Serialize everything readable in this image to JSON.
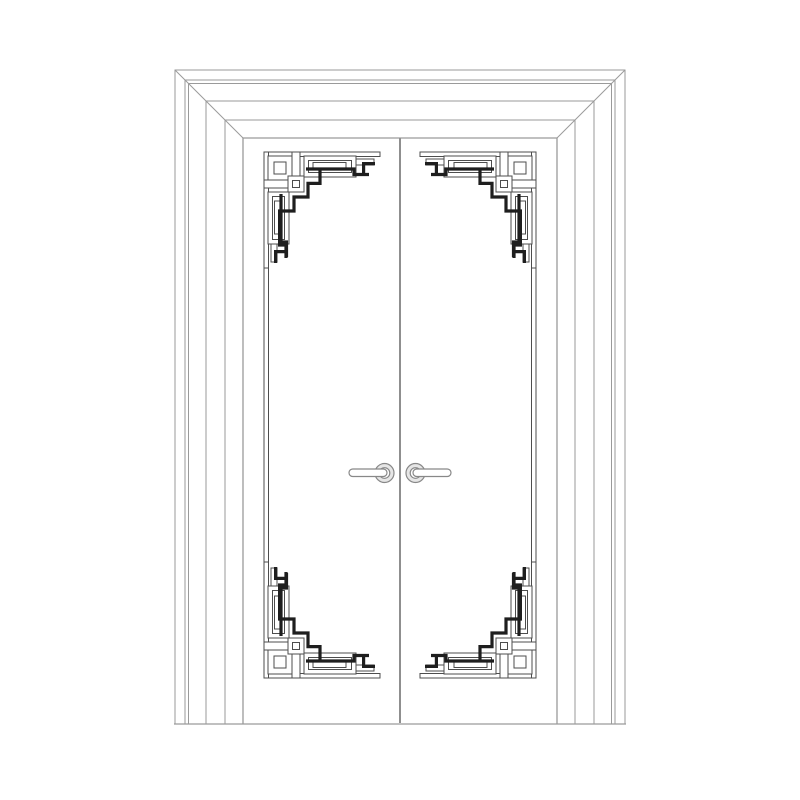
{
  "page": {
    "title": "Double door elevation drawing with Art Deco corner fretwork",
    "background": "#ffffff"
  },
  "colors": {
    "page_bg": "#ffffff",
    "frame_line": "#9a9a9a",
    "meeting_line": "#8f8f8f",
    "ornament_line": "#4d4d4d",
    "ornament_accent": "#1e1e1e",
    "hardware_line": "#888888",
    "rosette_fill": "#e6e6e6"
  },
  "drawing": {
    "type": "door-elevation",
    "style": "art-deco-fretwork",
    "frame_casing_lines": 6,
    "mitered_corners": 2,
    "door_leaves": 2,
    "corner_ornaments": 4,
    "edge_trim_rails": 2,
    "lever_handles": 2,
    "text_labels": []
  }
}
